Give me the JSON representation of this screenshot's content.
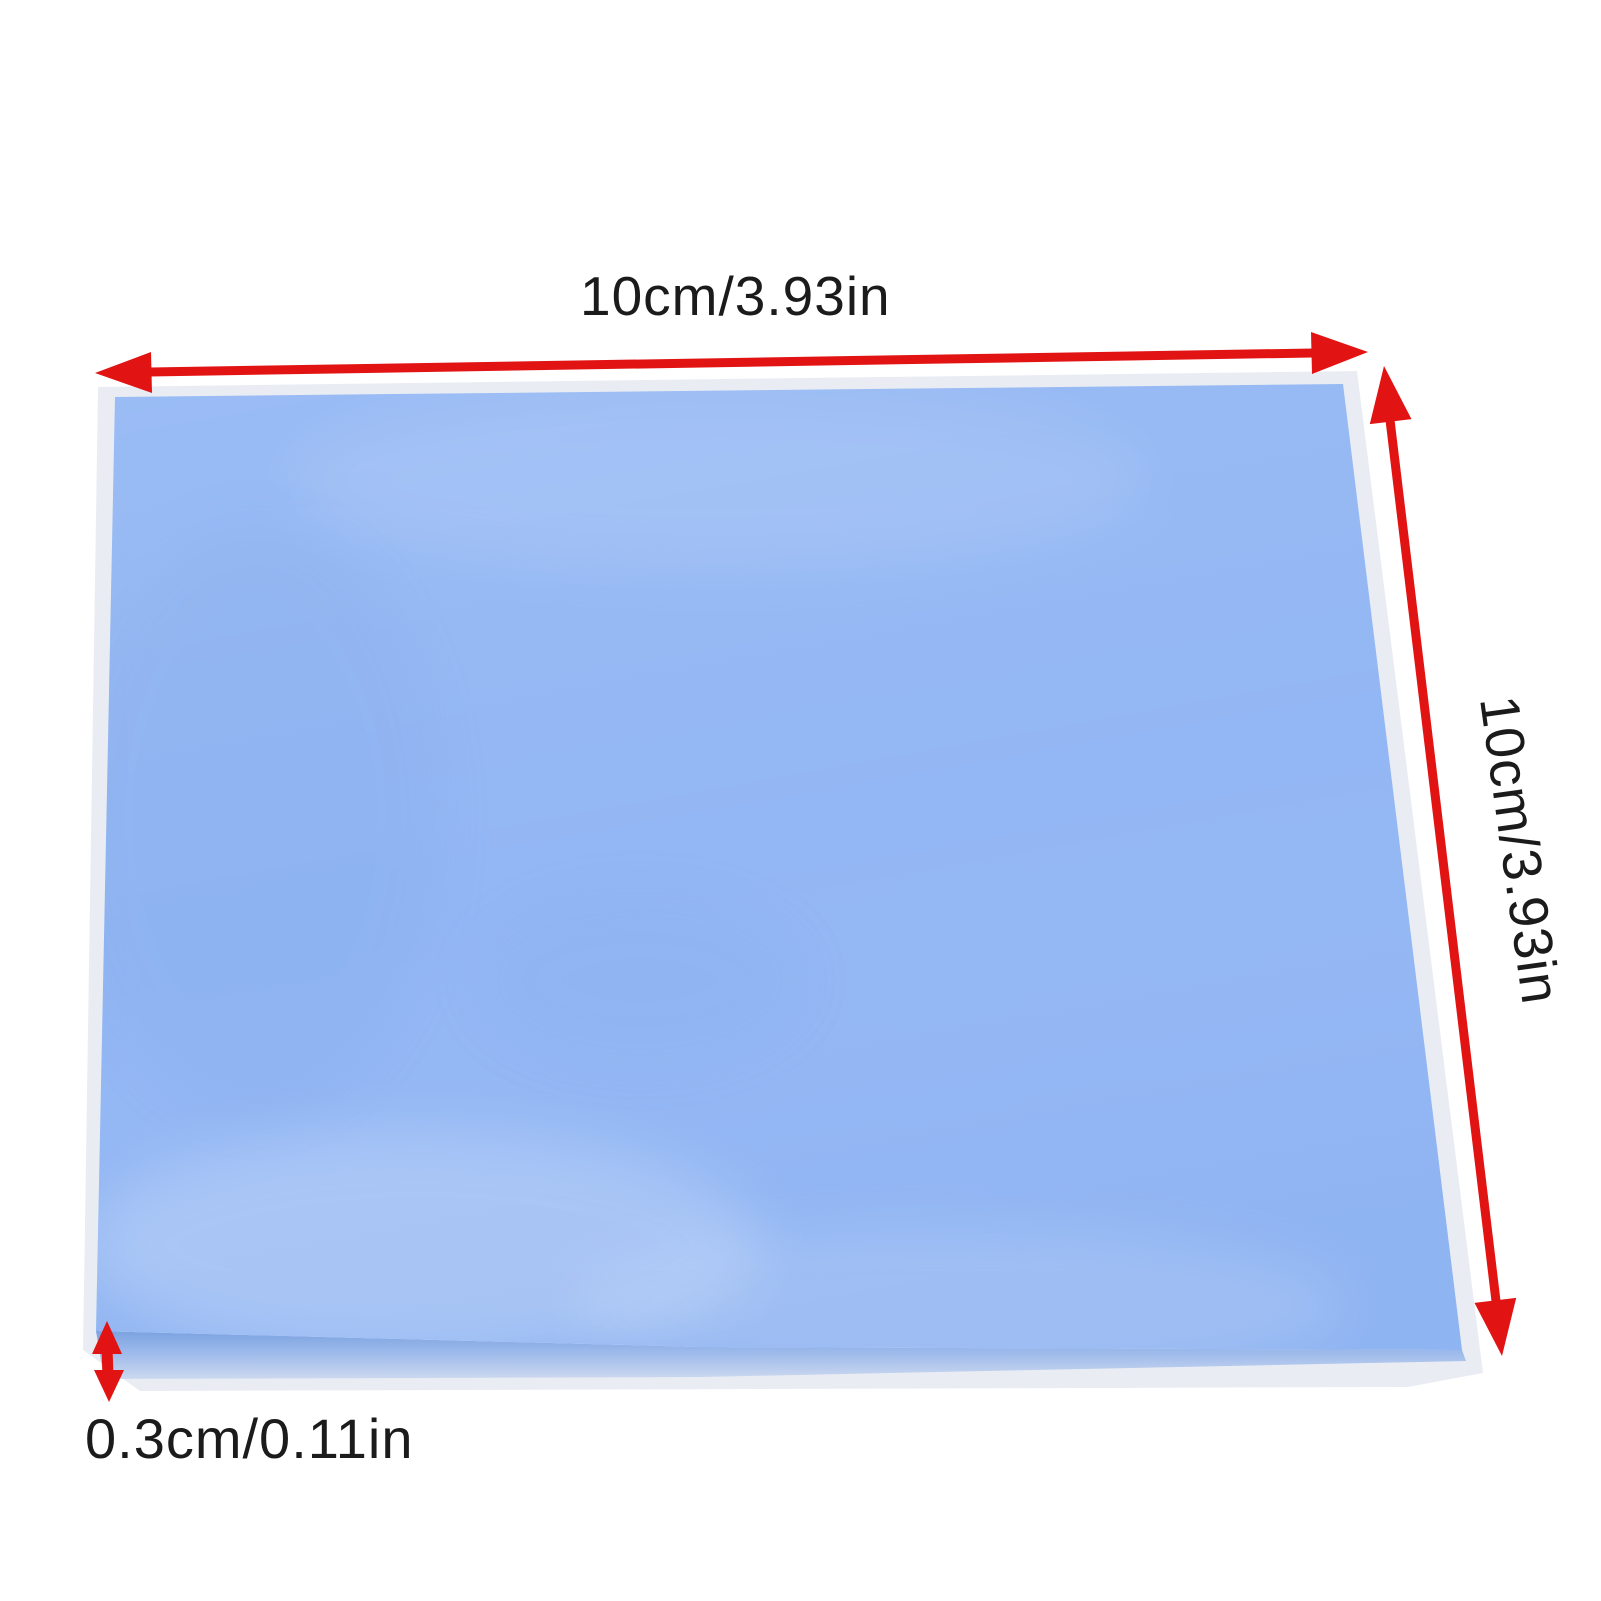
{
  "labels": {
    "width": "10cm/3.93in",
    "height": "10cm/3.93in",
    "thickness": "0.3cm/0.11in"
  },
  "colors": {
    "arrow_red": "#e21313",
    "pad_blue": "#93b7f4",
    "pad_edge_blue": "#8ab0ea",
    "film_gray": "#e9edf3",
    "text": "#1b1b1b",
    "background": "#ffffff"
  }
}
